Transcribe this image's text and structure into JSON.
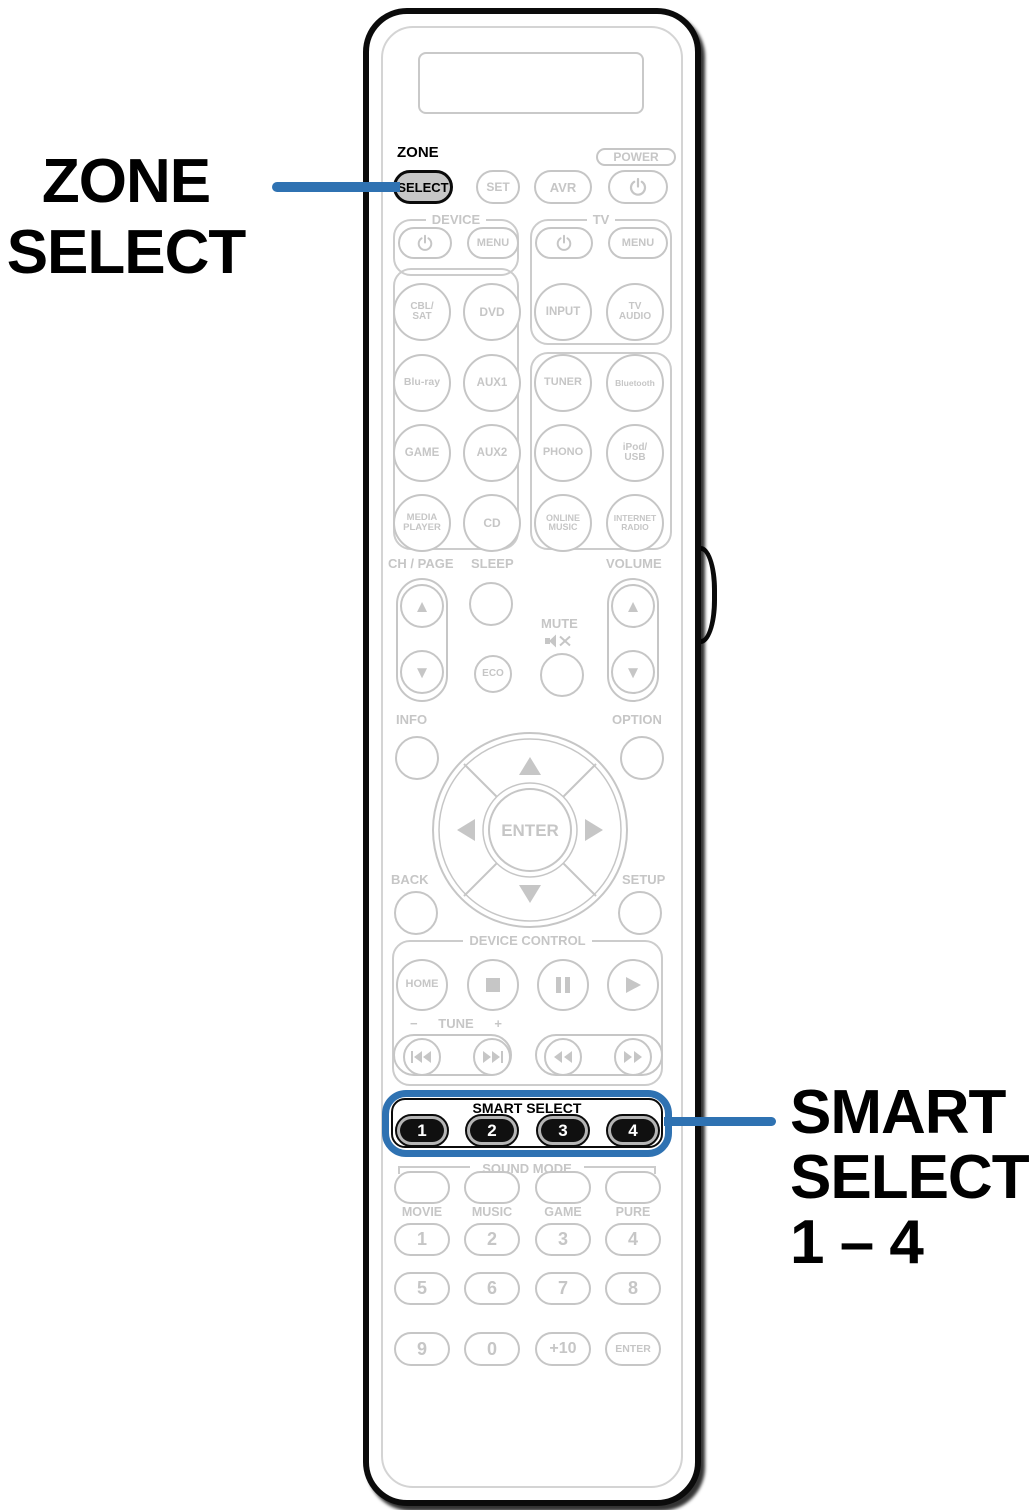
{
  "colors": {
    "highlight_blue": "#2f72b2",
    "inactive_gray": "#c6c6c6",
    "active_black": "#0b0b0b"
  },
  "callout_left": {
    "line1": "ZONE",
    "line2": "SELECT"
  },
  "callout_right": {
    "line1": "SMART",
    "line2": "SELECT",
    "line3": "1 – 4"
  },
  "remote": {
    "zone_label": "ZONE",
    "zone_select": "SELECT",
    "set": "SET",
    "avr": "AVR",
    "power_label": "POWER",
    "device": {
      "label": "DEVICE",
      "menu": "MENU"
    },
    "tv": {
      "label": "TV",
      "menu": "MENU",
      "input": "INPUT",
      "tv_audio": "TV\nAUDIO"
    },
    "sources_left": [
      "CBL/\nSAT",
      "DVD",
      "Blu-ray",
      "AUX1",
      "GAME",
      "AUX2",
      "MEDIA\nPLAYER",
      "CD"
    ],
    "sources_right": [
      "TUNER",
      "Bluetooth",
      "PHONO",
      "iPod/\nUSB",
      "ONLINE\nMUSIC",
      "INTERNET\nRADIO"
    ],
    "ch_page_label": "CH / PAGE",
    "sleep_label": "SLEEP",
    "eco": "ECO",
    "mute_label": "MUTE",
    "volume_label": "VOLUME",
    "info_label": "INFO",
    "option_label": "OPTION",
    "enter": "ENTER",
    "back_label": "BACK",
    "setup_label": "SETUP",
    "device_control_label": "DEVICE CONTROL",
    "home": "HOME",
    "tune": {
      "minus": "−",
      "label": "TUNE",
      "plus": "+"
    },
    "smart_select": {
      "label": "SMART SELECT",
      "buttons": [
        "1",
        "2",
        "3",
        "4"
      ]
    },
    "sound_mode": {
      "label": "SOUND MODE",
      "names": [
        "MOVIE",
        "MUSIC",
        "GAME",
        "PURE"
      ]
    },
    "numpad": {
      "row1": [
        "1",
        "2",
        "3",
        "4"
      ],
      "row2": [
        "5",
        "6",
        "7",
        "8"
      ],
      "row3": [
        "9",
        "0",
        "+10",
        "ENTER"
      ]
    }
  }
}
